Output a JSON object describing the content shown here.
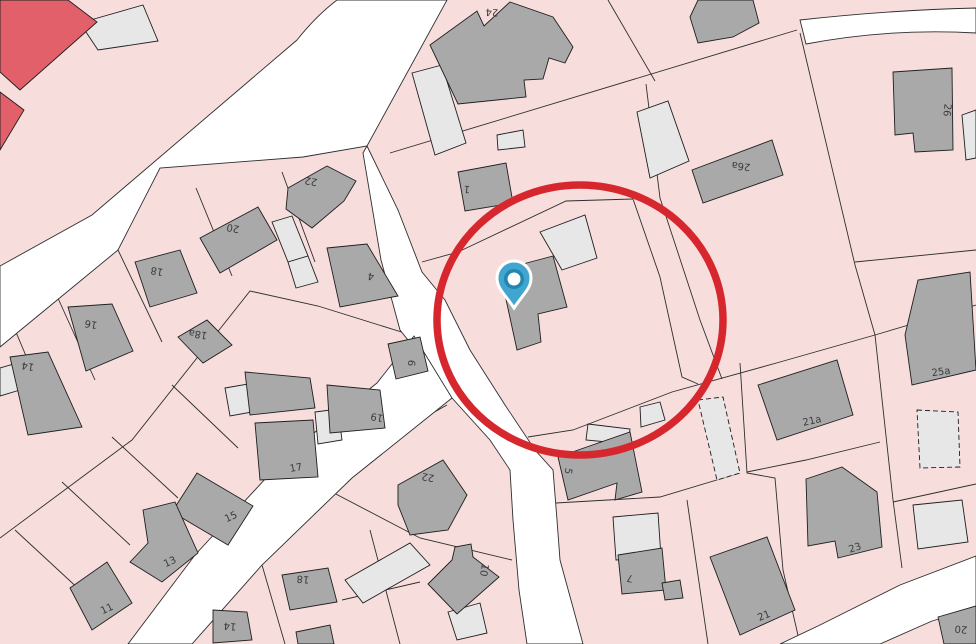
{
  "map": {
    "title": "cadastral-parcel-map-with-marker",
    "colors": {
      "background": "#F8DDDD",
      "parcel_line": "#2e2e2e",
      "road_fill": "#FFFFFF",
      "building_dark": "#A9A9A9",
      "building_light": "#E7E7E7",
      "building_red": "#E2606A",
      "building_outline": "#1f1f1f",
      "annotation_circle": "#D7272E",
      "pin_body": "#41A6CF",
      "pin_ring": "#2286AE",
      "pin_center": "#FFFFFF",
      "label_color": "#3b3b3b"
    },
    "annotation": {
      "circle": {
        "cx": 580,
        "cy": 320,
        "rx": 143,
        "ry": 135,
        "stroke_width": 7.5
      },
      "pin": {
        "x": 514,
        "y": 308,
        "tip_x": 514,
        "tip_y": 308
      }
    },
    "roads": [
      {
        "name": "road-west-diagonal",
        "d": "M337,0 L447,0 L367,146 L303,157 L160,168 L118,250 L0,347 L0,266 L92,215 L297,40 Q316,16 337,0 Z"
      },
      {
        "name": "road-center-vertical",
        "d": "M367,146 L398,210 L422,272 L445,300 L470,350 L505,405 L535,450 L553,470 L557,520 L560,560 L583,644 L527,644 L519,590 L513,520 L510,470 L490,440 L452,398 L420,355 L400,330 L381,260 L363,153 Z"
      },
      {
        "name": "road-southwest-diagonal",
        "d": "M414,336 L452,398 L352,478 L262,565 L192,644 L128,644 L195,555 L290,452 L377,383 Z"
      },
      {
        "name": "road-southeast-corner",
        "d": "M976,556 L900,585 L820,625 L780,644 L880,644 L932,621 L976,608 Z"
      },
      {
        "name": "road-northeast-strip",
        "d": "M800,20 Q890,10 976,8 L976,33 Q890,28 806,44 Z"
      }
    ],
    "parcel_lines": [
      {
        "points": "390,153 797,30"
      },
      {
        "points": "800,33 855,265 875,335 893,500 902,568"
      },
      {
        "points": "528,437 573,430 672,392 780,362 875,335 976,305"
      },
      {
        "points": "855,262 976,250"
      },
      {
        "points": "633,199 660,277 682,377 698,384"
      },
      {
        "points": "646,84 660,198 700,320 722,379"
      },
      {
        "points": "608,0 655,81"
      },
      {
        "points": "422,262 458,252 566,201 633,199"
      },
      {
        "points": "740,363 747,473 775,478 783,570 800,644"
      },
      {
        "points": "556,503 660,497 740,473"
      },
      {
        "points": "687,500 708,644"
      },
      {
        "points": "747,472 806,460 880,442"
      },
      {
        "points": "893,502 976,484"
      },
      {
        "points": "282,172 315,262"
      },
      {
        "points": "196,188 232,276"
      },
      {
        "points": "118,250 162,342"
      },
      {
        "points": "52,285 95,380"
      },
      {
        "points": "10,318 48,408"
      },
      {
        "points": "408,334 318,306 250,291 132,440 66,489 0,538"
      },
      {
        "points": "238,448 172,385"
      },
      {
        "points": "178,498 112,437"
      },
      {
        "points": "130,545 62,482"
      },
      {
        "points": "82,592 15,530"
      },
      {
        "points": "393,435 447,405"
      },
      {
        "points": "332,492 420,538 512,560"
      },
      {
        "points": "370,530 400,644"
      },
      {
        "points": "262,565 285,644"
      },
      {
        "points": "342,600 420,582"
      }
    ],
    "buildings_red": [
      {
        "pts": "0,0 68,0 97,22 20,90 0,72"
      },
      {
        "pts": "0,92 24,110 0,150"
      }
    ],
    "buildings_light": [
      {
        "pts": "80,23 143,5 158,41 98,50"
      },
      {
        "pts": "412,73 442,65 466,143 435,155"
      },
      {
        "pts": "497,135 523,130 525,147 498,150"
      },
      {
        "pts": "272,222 292,216 308,256 288,262"
      },
      {
        "pts": "288,262 308,256 318,282 296,288"
      },
      {
        "pts": "0,368 14,364 20,390 0,396"
      },
      {
        "pts": "315,412 338,409 342,440 318,444"
      },
      {
        "pts": "225,388 248,384 252,412 230,416"
      },
      {
        "pts": "540,232 585,215 597,258 562,270"
      },
      {
        "pts": "588,424 630,429 628,444 586,440"
      },
      {
        "pts": "613,517 658,513 661,557 616,560"
      },
      {
        "pts": "640,407 660,402 665,420 641,427"
      },
      {
        "pts": "448,612 480,603 487,633 457,640"
      },
      {
        "pts": "345,580 410,543 430,565 363,603"
      },
      {
        "pts": "913,505 962,500 968,542 918,549"
      },
      {
        "pts": "962,115 976,110 976,158 966,160"
      },
      {
        "pts": "637,112 668,101 689,161 650,178"
      }
    ],
    "buildings_dashed": [
      {
        "pts": "698,400 723,397 740,473 717,480"
      },
      {
        "pts": "917,410 958,412 960,467 920,468"
      }
    ],
    "buildings_dark": [
      {
        "pts": "430,45 477,11 484,26 510,2 553,17 573,47 565,63 549,58 543,79 524,80 526,97 458,104"
      },
      {
        "pts": "458,172 506,163 513,203 465,211"
      },
      {
        "pts": "288,188 327,166 356,181 344,201 312,228 286,209"
      },
      {
        "pts": "200,238 258,207 277,240 220,273"
      },
      {
        "pts": "135,262 180,250 197,293 150,307"
      },
      {
        "pts": "68,307 112,304 133,351 86,371"
      },
      {
        "pts": "10,357 48,352 82,427 28,435"
      },
      {
        "pts": "178,337 207,320 232,345 203,363"
      },
      {
        "pts": "327,248 367,244 398,296 340,307"
      },
      {
        "pts": "388,344 420,337 428,371 396,379"
      },
      {
        "pts": "245,372 310,378 315,408 250,415"
      },
      {
        "pts": "327,385 380,390 385,428 330,433"
      },
      {
        "pts": "255,423 313,420 318,477 260,480"
      },
      {
        "pts": "197,473 253,506 228,545 172,512"
      },
      {
        "pts": "143,510 175,502 198,553 162,582 130,562 148,543"
      },
      {
        "pts": "70,588 107,562 132,603 92,630"
      },
      {
        "pts": "213,610 247,612 252,640 213,643"
      },
      {
        "pts": "282,575 328,568 337,602 290,610"
      },
      {
        "pts": "398,485 443,460 467,495 448,530 410,535 398,505"
      },
      {
        "pts": "428,584 452,560 455,547 471,544 473,557 499,577 457,614"
      },
      {
        "pts": "296,632 330,625 334,644 298,644"
      },
      {
        "pts": "502,281 523,264 553,256 567,307 538,314 541,342 517,350"
      },
      {
        "pts": "558,457 630,432 642,492 615,500 617,483 568,500"
      },
      {
        "pts": "618,555 662,548 666,590 622,594"
      },
      {
        "pts": "662,583 680,580 683,598 665,600"
      },
      {
        "pts": "710,557 767,537 795,610 740,635"
      },
      {
        "pts": "806,479 842,467 877,492 882,547 838,558 835,541 808,546"
      },
      {
        "pts": "758,385 837,360 853,415 777,440"
      },
      {
        "pts": "905,335 918,280 970,272 976,370 912,385"
      },
      {
        "pts": "893,72 952,68 953,150 915,152 913,133 895,135"
      },
      {
        "pts": "692,170 772,140 783,175 703,203"
      },
      {
        "pts": "690,17 698,0 753,0 759,23 733,37 698,43"
      },
      {
        "pts": "938,617 976,606 976,644 944,644"
      }
    ],
    "labels": [
      {
        "text": "24",
        "x": 492,
        "y": 12,
        "rot": 183
      },
      {
        "text": "1",
        "x": 467,
        "y": 189,
        "rot": 185
      },
      {
        "text": "26a",
        "x": 741,
        "y": 166,
        "rot": 187
      },
      {
        "text": "26",
        "x": 947,
        "y": 110,
        "rot": 96
      },
      {
        "text": "22",
        "x": 311,
        "y": 181,
        "rot": 190
      },
      {
        "text": "20",
        "x": 233,
        "y": 228,
        "rot": 190
      },
      {
        "text": "18",
        "x": 157,
        "y": 271,
        "rot": 190
      },
      {
        "text": "4",
        "x": 371,
        "y": 276,
        "rot": 190
      },
      {
        "text": "18a",
        "x": 198,
        "y": 334,
        "rot": 190
      },
      {
        "text": "16",
        "x": 91,
        "y": 324,
        "rot": 190
      },
      {
        "text": "14",
        "x": 28,
        "y": 366,
        "rot": 190
      },
      {
        "text": "6",
        "x": 411,
        "y": 363,
        "rot": 96
      },
      {
        "text": "19",
        "x": 377,
        "y": 417,
        "rot": 190
      },
      {
        "text": "17",
        "x": 296,
        "y": 468,
        "rot": -10
      },
      {
        "text": "15",
        "x": 231,
        "y": 517,
        "rot": -25
      },
      {
        "text": "13",
        "x": 170,
        "y": 562,
        "rot": -25
      },
      {
        "text": "11",
        "x": 107,
        "y": 609,
        "rot": -25
      },
      {
        "text": "14",
        "x": 230,
        "y": 626,
        "rot": 185
      },
      {
        "text": "18",
        "x": 303,
        "y": 579,
        "rot": 185
      },
      {
        "text": "22",
        "x": 428,
        "y": 477,
        "rot": 190
      },
      {
        "text": "10",
        "x": 484,
        "y": 570,
        "rot": 100
      },
      {
        "text": "5",
        "x": 568,
        "y": 471,
        "rot": 100
      },
      {
        "text": "7",
        "x": 630,
        "y": 578,
        "rot": 190
      },
      {
        "text": "21",
        "x": 764,
        "y": 616,
        "rot": -22
      },
      {
        "text": "23",
        "x": 855,
        "y": 548,
        "rot": -18
      },
      {
        "text": "21a",
        "x": 812,
        "y": 421,
        "rot": -12
      },
      {
        "text": "25a",
        "x": 941,
        "y": 372,
        "rot": -8
      },
      {
        "text": "20",
        "x": 961,
        "y": 629,
        "rot": 185
      }
    ]
  }
}
